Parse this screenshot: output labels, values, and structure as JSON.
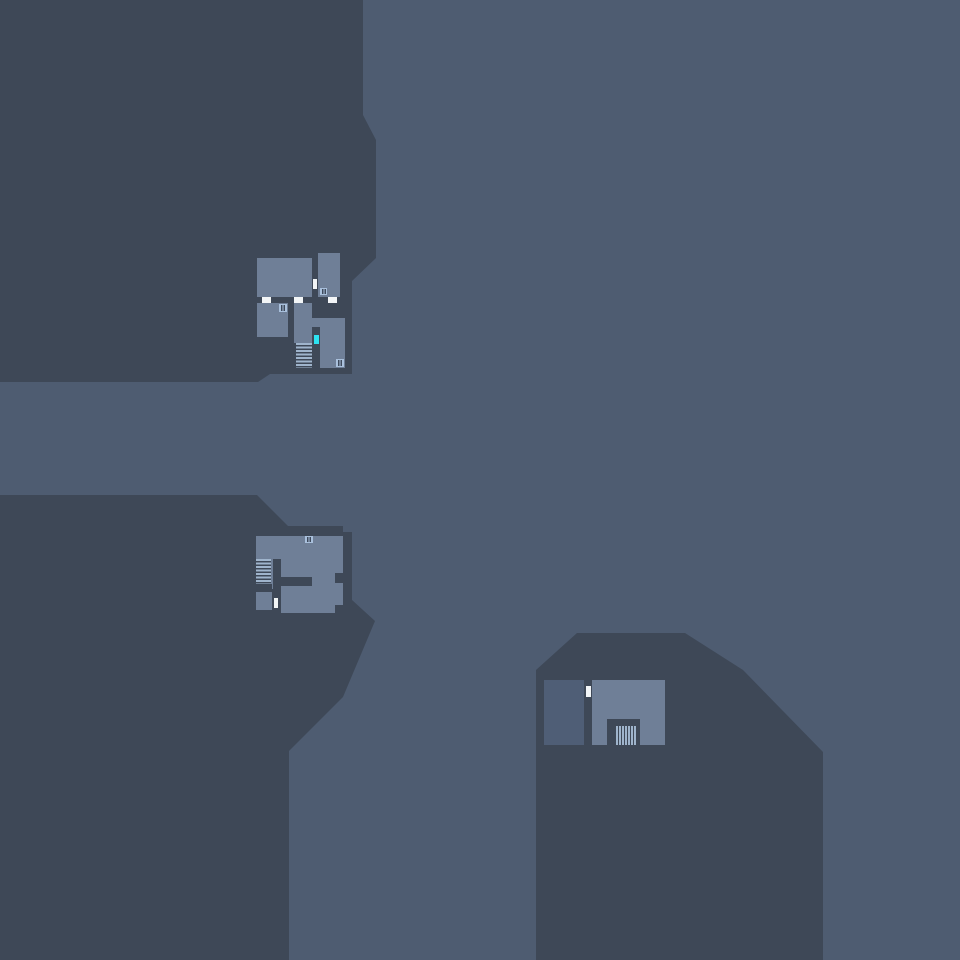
{
  "scene": {
    "width": 960,
    "height": 960,
    "colors": {
      "background": "#4e5c71",
      "terrain": "#3e4857",
      "room": "#6f7f97",
      "room_dim": "#4f5e76",
      "door": "#f2f5f7",
      "objective": "#2de2f1",
      "stair_stripe": "#9fb4cc",
      "vent_frame": "#a9c0dc",
      "vent_slit": "#3e4a5c"
    },
    "terrain": [
      {
        "name": "terrain-upper-left",
        "points": "0,0 363,0 363,115 376,140 376,258 352,281 352,374 270,374 258,382 0,382"
      },
      {
        "name": "terrain-lower-left",
        "points": "0,495 257,495 288,526 343,526 343,532 352,532 352,600 375,621 343,697 289,751 289,960 0,960"
      },
      {
        "name": "terrain-lower-right",
        "points": "536,670 577,633 685,633 743,670 823,752 823,960 536,960"
      }
    ],
    "buildings": [
      {
        "id": "building-upper",
        "parts": [
          {
            "type": "room",
            "name": "room",
            "x": 257,
            "y": 258,
            "w": 55,
            "h": 39
          },
          {
            "type": "room",
            "name": "room",
            "x": 318,
            "y": 253,
            "w": 22,
            "h": 44
          },
          {
            "type": "room",
            "name": "room",
            "x": 257,
            "y": 303,
            "w": 31,
            "h": 34
          },
          {
            "type": "room",
            "name": "corridor",
            "x": 294,
            "y": 303,
            "w": 18,
            "h": 40
          },
          {
            "type": "room",
            "name": "corridor",
            "x": 312,
            "y": 318,
            "w": 33,
            "h": 9
          },
          {
            "type": "room",
            "name": "room",
            "x": 320,
            "y": 327,
            "w": 25,
            "h": 41
          },
          {
            "type": "stair-h",
            "name": "stairs-icon",
            "x": 296,
            "y": 343,
            "w": 16,
            "h": 25
          },
          {
            "type": "door",
            "name": "door-icon",
            "x": 313,
            "y": 279,
            "w": 4,
            "h": 10
          },
          {
            "type": "door",
            "name": "door-icon",
            "x": 262,
            "y": 297,
            "w": 9,
            "h": 6
          },
          {
            "type": "door",
            "name": "door-icon",
            "x": 294,
            "y": 297,
            "w": 9,
            "h": 6
          },
          {
            "type": "door",
            "name": "door-icon",
            "x": 328,
            "y": 297,
            "w": 9,
            "h": 6
          },
          {
            "type": "vent",
            "name": "vent-icon",
            "x": 320,
            "y": 288,
            "w": 7,
            "h": 7
          },
          {
            "type": "vent",
            "name": "vent-icon",
            "x": 279,
            "y": 304,
            "w": 8,
            "h": 8
          },
          {
            "type": "vent",
            "name": "vent-icon",
            "x": 336,
            "y": 359,
            "w": 8,
            "h": 8
          },
          {
            "type": "objective",
            "name": "objective-marker",
            "x": 314,
            "y": 335,
            "w": 5,
            "h": 9
          }
        ]
      },
      {
        "id": "building-middle",
        "parts": [
          {
            "type": "room",
            "name": "room",
            "x": 256,
            "y": 536,
            "w": 87,
            "h": 77
          },
          {
            "type": "wall",
            "name": "wall",
            "x": 273,
            "y": 559,
            "w": 8,
            "h": 30
          },
          {
            "type": "wall",
            "name": "wall",
            "x": 281,
            "y": 577,
            "w": 31,
            "h": 9
          },
          {
            "type": "wall",
            "name": "wall",
            "x": 256,
            "y": 584,
            "w": 16,
            "h": 8
          },
          {
            "type": "wall",
            "name": "wall",
            "x": 272,
            "y": 589,
            "w": 9,
            "h": 24
          },
          {
            "type": "wall",
            "name": "wall",
            "x": 335,
            "y": 573,
            "w": 8,
            "h": 10
          },
          {
            "type": "wall",
            "name": "wall",
            "x": 335,
            "y": 605,
            "w": 8,
            "h": 8
          },
          {
            "type": "wall",
            "name": "wall",
            "x": 256,
            "y": 610,
            "w": 16,
            "h": 3
          },
          {
            "type": "stair-h",
            "name": "stairs-icon",
            "x": 256,
            "y": 559,
            "w": 15,
            "h": 25
          },
          {
            "type": "door",
            "name": "door-icon",
            "x": 274,
            "y": 598,
            "w": 4,
            "h": 10
          },
          {
            "type": "vent",
            "name": "vent-icon",
            "x": 305,
            "y": 536,
            "w": 8,
            "h": 7
          }
        ]
      },
      {
        "id": "building-lower-right",
        "parts": [
          {
            "type": "room-dim",
            "name": "room",
            "x": 544,
            "y": 680,
            "w": 40,
            "h": 65
          },
          {
            "type": "room",
            "name": "room",
            "x": 592,
            "y": 680,
            "w": 73,
            "h": 65
          },
          {
            "type": "wall",
            "name": "alcove",
            "x": 607,
            "y": 719,
            "w": 33,
            "h": 26
          },
          {
            "type": "stair-v",
            "name": "grate-icon",
            "x": 616,
            "y": 726,
            "w": 21,
            "h": 19
          },
          {
            "type": "door",
            "name": "door-icon",
            "x": 586,
            "y": 686,
            "w": 5,
            "h": 11
          }
        ]
      }
    ]
  }
}
